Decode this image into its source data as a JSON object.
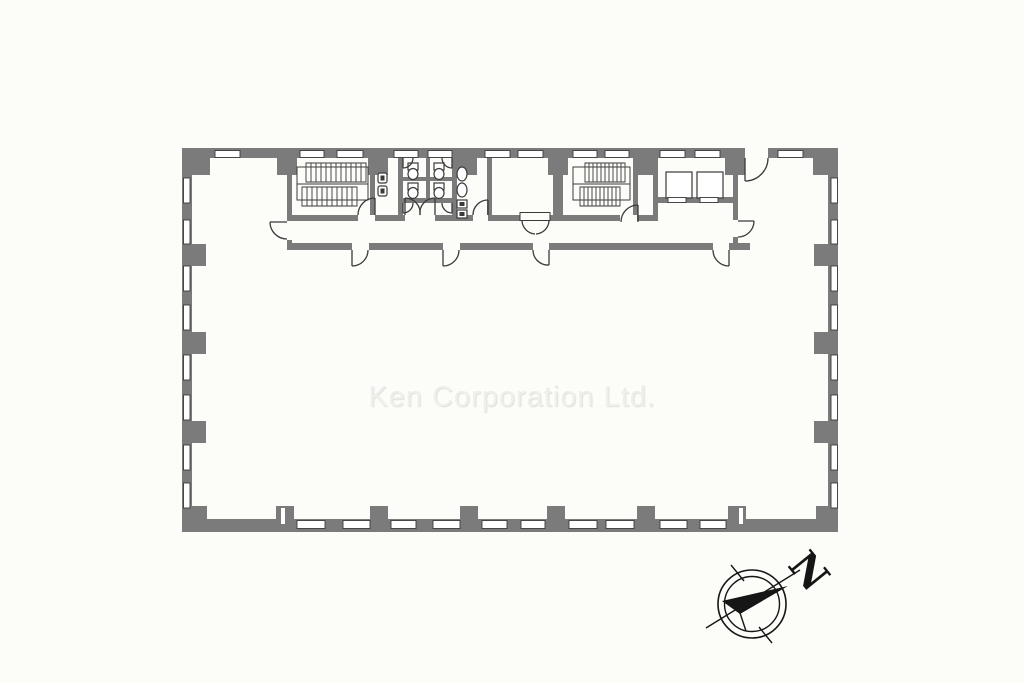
{
  "watermark": {
    "text": "Ken Corporation Ltd."
  },
  "compass": {
    "north_label": "N"
  },
  "colors": {
    "background": "#fcfcf8",
    "wall": "#7b7b7b",
    "line": "#3a3a3a",
    "hatch": "#4a4a4a",
    "watermark_color": "#efefec",
    "compass_ink": "#161616"
  },
  "plan": {
    "type": "office-floor-plan",
    "features": [
      "exterior-walls",
      "structural-columns",
      "window-openings",
      "staircase-west",
      "staircase-east",
      "washroom",
      "toilet-stalls",
      "urinal-room",
      "vestibule-double-door",
      "elevator-bank",
      "corridor",
      "door-swings",
      "north-compass"
    ]
  }
}
